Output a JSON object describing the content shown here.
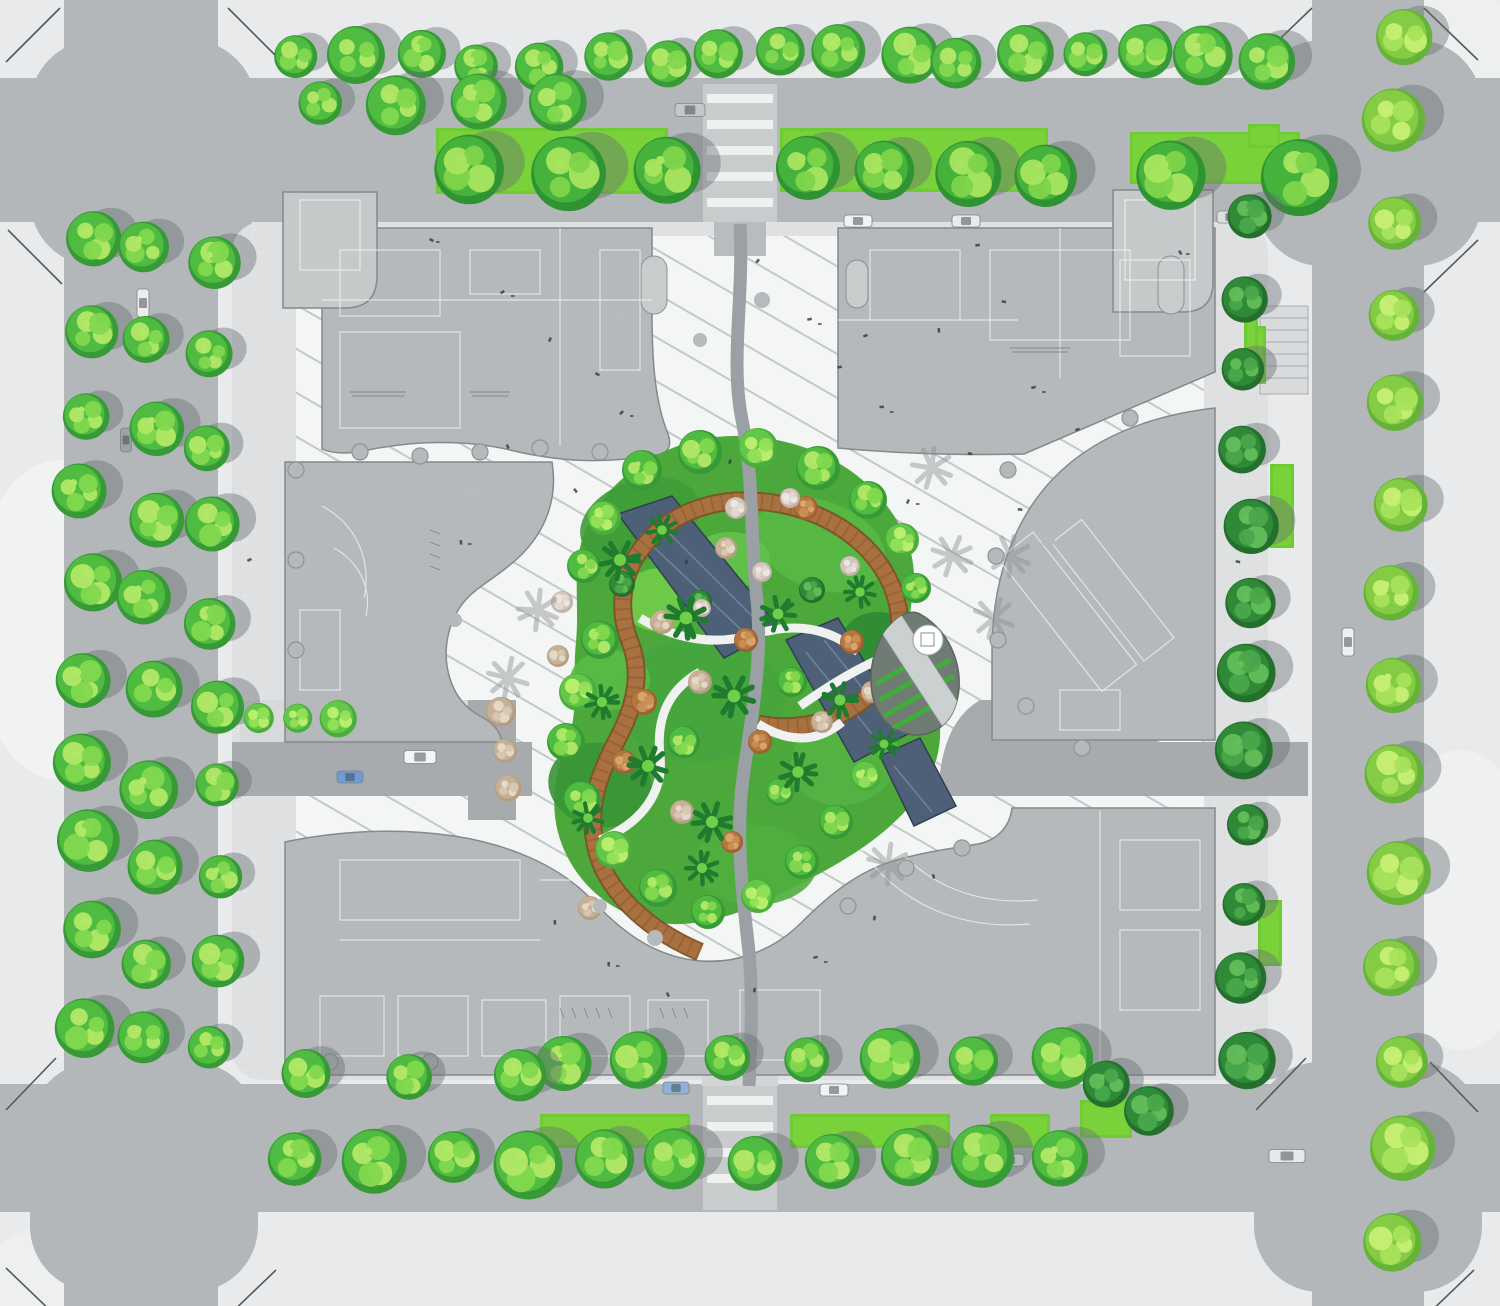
{
  "meta": {
    "type": "architectural-landscape-site-plan",
    "visible_text": "none",
    "features": [
      "street-intersections",
      "perimeter-tree-rows",
      "four-building-roofs",
      "striped-pinwheel-plaza",
      "central-garden",
      "reflecting-pools",
      "timber-ribbon-walk",
      "pavilion-teardrop",
      "grass-medians",
      "cars",
      "pedestrians"
    ]
  },
  "palette": {
    "background": "#e9eaeb",
    "road": "#b4b7b9",
    "road_dark": "#a7abad",
    "sidewalk": "#dfe1e2",
    "paver_line": "#c9cbcc",
    "plaza": "#f4f5f5",
    "stripe": "#c5c8c9",
    "building": "#b5b9bb",
    "building_stroke": "#85898b",
    "building_line": "#f2f4f4",
    "sub_building": "#c6c9ca",
    "water": "#4d6077",
    "water_edge": "#2f3f50",
    "water_streak": "#7e90a4",
    "ribbon": "#a9713f",
    "ribbon_dark": "#7e5227",
    "grass": "#6fcb33",
    "grass_light": "#8fdf4a",
    "pavilion": "#6f7b73",
    "pavilion_stripe": "#3fae3b",
    "shadow": "#666e73",
    "speck": "#3a3f42",
    "planter_dot": "#b6babc",
    "tree_types": {
      "g": {
        "base": "#379a36",
        "mid": "#4fbb41",
        "light": "#82d84e",
        "lime": "#b2e866"
      },
      "big": {
        "base": "#2f9233",
        "mid": "#45b23c",
        "light": "#7fd44a",
        "lime": "#a8e55e"
      },
      "lg": {
        "base": "#4aad3c",
        "mid": "#63c74a",
        "light": "#95e057",
        "lime": "#bdf06e"
      },
      "dg": {
        "base": "#256f2d",
        "mid": "#2f8a38",
        "light": "#4aa84b",
        "lime": "#63bd58"
      },
      "lime": {
        "base": "#66b33a",
        "mid": "#85cc45",
        "light": "#a8e35b",
        "lime": "#c6ef74"
      },
      "tan": {
        "base": "#b49e83",
        "mid": "#c6b096",
        "light": "#d8c8b2",
        "lime": "#e6dac8"
      },
      "rust": {
        "base": "#a05f32",
        "mid": "#b5763f",
        "light": "#c98f55",
        "lime": "#d9a86d"
      },
      "pale": {
        "base": "#c0b2a8",
        "mid": "#d3c6bd",
        "light": "#e4dad2",
        "lime": "#efe8e2"
      },
      "palm": {
        "base": "#1f7c2e",
        "mid": "#2f9338",
        "light": "#6fcf49",
        "lime": "#9ade5f"
      }
    }
  },
  "scene": {
    "tree_rows": [
      {
        "x1": 302,
        "y1": 60,
        "x2": 1262,
        "y2": 58,
        "n": 17,
        "r": 26,
        "j": 16,
        "t": "g",
        "s": 1
      },
      {
        "x1": 320,
        "y1": 108,
        "x2": 560,
        "y2": 104,
        "n": 4,
        "r": 26,
        "j": 10,
        "t": "g",
        "s": 1
      },
      {
        "x1": 466,
        "y1": 170,
        "x2": 664,
        "y2": 172,
        "n": 3,
        "r": 37,
        "j": 8,
        "t": "big",
        "s": 1
      },
      {
        "x1": 806,
        "y1": 170,
        "x2": 1044,
        "y2": 172,
        "n": 4,
        "r": 36,
        "j": 8,
        "t": "big",
        "s": 1
      },
      {
        "x1": 1168,
        "y1": 176,
        "x2": 1298,
        "y2": 178,
        "n": 2,
        "r": 34,
        "j": 6,
        "t": "big",
        "s": 1
      },
      {
        "x1": 88,
        "y1": 238,
        "x2": 88,
        "y2": 1020,
        "n": 10,
        "r": 27,
        "j": 18,
        "t": "g",
        "s": 1
      },
      {
        "x1": 152,
        "y1": 256,
        "x2": 152,
        "y2": 1044,
        "n": 10,
        "r": 28,
        "j": 18,
        "t": "g",
        "s": 1
      },
      {
        "x1": 214,
        "y1": 268,
        "x2": 214,
        "y2": 1052,
        "n": 10,
        "r": 26,
        "j": 16,
        "t": "g",
        "s": 1
      },
      {
        "x1": 1246,
        "y1": 218,
        "x2": 1246,
        "y2": 1058,
        "n": 12,
        "r": 25,
        "j": 12,
        "t": "dg",
        "s": 1
      },
      {
        "x1": 1398,
        "y1": 34,
        "x2": 1398,
        "y2": 1244,
        "n": 14,
        "r": 29,
        "j": 14,
        "t": "lime",
        "s": 1
      },
      {
        "x1": 560,
        "y1": 1062,
        "x2": 1058,
        "y2": 1060,
        "n": 7,
        "r": 27,
        "j": 10,
        "t": "g",
        "s": 1
      },
      {
        "x1": 302,
        "y1": 1072,
        "x2": 516,
        "y2": 1072,
        "n": 3,
        "r": 26,
        "j": 10,
        "t": "g",
        "s": 1
      },
      {
        "x1": 296,
        "y1": 1162,
        "x2": 1062,
        "y2": 1162,
        "n": 11,
        "r": 30,
        "j": 12,
        "t": "g",
        "s": 1
      },
      {
        "x1": 258,
        "y1": 718,
        "x2": 338,
        "y2": 718,
        "n": 3,
        "r": 16,
        "j": 4,
        "t": "lg",
        "s": 0
      },
      {
        "x1": 500,
        "y1": 712,
        "x2": 510,
        "y2": 786,
        "n": 3,
        "r": 14,
        "j": 6,
        "t": "tan",
        "s": 0
      },
      {
        "x1": 1108,
        "y1": 1086,
        "x2": 1150,
        "y2": 1112,
        "n": 2,
        "r": 24,
        "j": 6,
        "t": "dg",
        "s": 1
      }
    ],
    "garden_trees": [
      [
        642,
        470,
        20,
        "g"
      ],
      [
        700,
        452,
        22,
        "g"
      ],
      [
        758,
        448,
        20,
        "lg"
      ],
      [
        818,
        468,
        22,
        "g"
      ],
      [
        868,
        500,
        19,
        "g"
      ],
      [
        902,
        540,
        17,
        "lg"
      ],
      [
        916,
        588,
        15,
        "g"
      ],
      [
        604,
        518,
        17,
        "lg"
      ],
      [
        584,
        566,
        17,
        "g"
      ],
      [
        600,
        640,
        19,
        "g"
      ],
      [
        578,
        692,
        19,
        "lg"
      ],
      [
        566,
        742,
        19,
        "g"
      ],
      [
        582,
        800,
        19,
        "g"
      ],
      [
        614,
        850,
        19,
        "lg"
      ],
      [
        658,
        888,
        19,
        "g"
      ],
      [
        708,
        912,
        17,
        "g"
      ],
      [
        758,
        896,
        17,
        "lg"
      ],
      [
        802,
        862,
        17,
        "g"
      ],
      [
        836,
        822,
        17,
        "g"
      ],
      [
        866,
        776,
        15,
        "lg"
      ],
      [
        896,
        640,
        13,
        "g"
      ],
      [
        792,
        682,
        15,
        "g"
      ],
      [
        780,
        792,
        14,
        "g"
      ],
      [
        684,
        742,
        16,
        "g"
      ],
      [
        622,
        584,
        13,
        "dg"
      ],
      [
        700,
        602,
        12,
        "dg"
      ],
      [
        812,
        590,
        13,
        "dg"
      ],
      [
        644,
        702,
        13,
        "rust"
      ],
      [
        760,
        742,
        12,
        "rust"
      ],
      [
        746,
        640,
        12,
        "rust"
      ],
      [
        852,
        642,
        12,
        "rust"
      ],
      [
        624,
        762,
        12,
        "rust"
      ],
      [
        732,
        842,
        11,
        "rust"
      ],
      [
        806,
        508,
        12,
        "rust"
      ],
      [
        700,
        682,
        12,
        "tan"
      ],
      [
        822,
        722,
        11,
        "tan"
      ],
      [
        662,
        622,
        12,
        "tan"
      ],
      [
        872,
        692,
        11,
        "tan"
      ],
      [
        682,
        812,
        12,
        "tan"
      ],
      [
        558,
        656,
        11,
        "tan"
      ],
      [
        590,
        908,
        12,
        "tan"
      ],
      [
        726,
        548,
        11,
        "tan"
      ],
      [
        736,
        508,
        11,
        "pale"
      ],
      [
        790,
        498,
        10,
        "pale"
      ],
      [
        762,
        572,
        10,
        "pale"
      ],
      [
        562,
        602,
        11,
        "pale"
      ],
      [
        702,
        608,
        9,
        "pale"
      ],
      [
        850,
        566,
        10,
        "pale"
      ],
      [
        620,
        560,
        19,
        "palm"
      ],
      [
        686,
        618,
        20,
        "palm"
      ],
      [
        734,
        696,
        20,
        "palm"
      ],
      [
        648,
        766,
        19,
        "palm"
      ],
      [
        712,
        822,
        19,
        "palm"
      ],
      [
        798,
        772,
        18,
        "palm"
      ],
      [
        840,
        700,
        17,
        "palm"
      ],
      [
        778,
        614,
        17,
        "palm"
      ],
      [
        860,
        592,
        15,
        "palm"
      ],
      [
        602,
        702,
        16,
        "palm"
      ],
      [
        588,
        818,
        15,
        "palm"
      ],
      [
        702,
        868,
        16,
        "palm"
      ],
      [
        662,
        530,
        15,
        "palm"
      ],
      [
        884,
        744,
        14,
        "palm"
      ]
    ],
    "palm_shadows": [
      [
        952,
        556
      ],
      [
        994,
        618
      ],
      [
        932,
        468
      ],
      [
        888,
        864
      ],
      [
        538,
        610
      ],
      [
        508,
        678
      ],
      [
        1010,
        556
      ]
    ],
    "pools": [
      {
        "pts": "618,514 672,496 780,628 724,658",
        "streaks": [
          [
            640,
            534,
            752,
            640
          ],
          [
            660,
            524,
            766,
            630
          ]
        ]
      },
      {
        "pts": "786,640 838,618 908,734 854,762",
        "streaks": [
          [
            806,
            652,
            880,
            744
          ],
          [
            824,
            640,
            896,
            730
          ]
        ]
      },
      {
        "pts": "880,756 920,738 956,806 914,826",
        "streaks": [
          [
            894,
            766,
            932,
            812
          ]
        ]
      }
    ],
    "grass": [
      [
        436,
        128,
        232,
        66
      ],
      [
        780,
        128,
        268,
        64
      ],
      [
        1130,
        132,
        170,
        52
      ],
      [
        540,
        1114,
        150,
        34
      ],
      [
        790,
        1114,
        160,
        34
      ],
      [
        990,
        1114,
        60,
        34
      ],
      [
        1246,
        326,
        20,
        58
      ],
      [
        1270,
        464,
        24,
        84
      ],
      [
        1258,
        900,
        24,
        66
      ],
      [
        1248,
        124,
        32,
        24
      ],
      [
        1080,
        1100,
        52,
        38
      ],
      [
        1244,
        316,
        14,
        66
      ]
    ],
    "cars": [
      [
        690,
        110,
        30,
        13,
        0,
        "#c4c8ca"
      ],
      [
        858,
        221,
        28,
        12,
        0,
        "#f1f2f2"
      ],
      [
        966,
        221,
        28,
        12,
        0,
        "#e9ebec"
      ],
      [
        1230,
        217,
        26,
        12,
        0,
        "#dde0e1"
      ],
      [
        420,
        757,
        32,
        13,
        0,
        "#f4f5f5"
      ],
      [
        350,
        777,
        26,
        12,
        0,
        "#6f9bd2"
      ],
      [
        676,
        1088,
        26,
        12,
        0,
        "#8fb1d8"
      ],
      [
        834,
        1090,
        28,
        12,
        0,
        "#f1f2f2"
      ],
      [
        1010,
        1160,
        28,
        12,
        0,
        "#eceeee"
      ],
      [
        1287,
        1156,
        36,
        13,
        0,
        "#e6e8e9"
      ],
      [
        1348,
        642,
        28,
        12,
        90,
        "#eff0f1"
      ],
      [
        143,
        303,
        28,
        12,
        90,
        "#eceeee"
      ],
      [
        126,
        440,
        24,
        11,
        90,
        "#9aa2a8"
      ]
    ],
    "planter_dots": [
      [
        617,
        318,
        9
      ],
      [
        530,
        400,
        8
      ],
      [
        472,
        492,
        9
      ],
      [
        928,
        306,
        8
      ],
      [
        986,
        360,
        9
      ],
      [
        655,
        938,
        8
      ],
      [
        600,
        906,
        7
      ],
      [
        862,
        944,
        8
      ],
      [
        700,
        340,
        7
      ],
      [
        762,
        300,
        8
      ],
      [
        1048,
        540,
        7
      ],
      [
        455,
        620,
        7
      ]
    ],
    "specks": [
      [
        505,
        292
      ],
      [
        552,
        338
      ],
      [
        596,
        372
      ],
      [
        624,
        412
      ],
      [
        508,
        444
      ],
      [
        575,
        488
      ],
      [
        462,
        540
      ],
      [
        940,
        328
      ],
      [
        1002,
        300
      ],
      [
        1036,
        388
      ],
      [
        968,
        452
      ],
      [
        1018,
        508
      ],
      [
        884,
        408
      ],
      [
        842,
        368
      ],
      [
        556,
        920
      ],
      [
        610,
        962
      ],
      [
        668,
        992
      ],
      [
        756,
        988
      ],
      [
        818,
        958
      ],
      [
        876,
        916
      ],
      [
        934,
        874
      ],
      [
        812,
        320
      ],
      [
        868,
        336
      ],
      [
        1080,
        430
      ],
      [
        910,
        500
      ],
      [
        252,
        560
      ],
      [
        1236,
        560
      ],
      [
        1236,
        760
      ],
      [
        640,
        1072
      ],
      [
        900,
        1068
      ],
      [
        430,
        238
      ],
      [
        760,
        260
      ],
      [
        980,
        246
      ],
      [
        1180,
        250
      ],
      [
        688,
        560
      ],
      [
        732,
        460
      ]
    ],
    "columns": [
      [
        360,
        452
      ],
      [
        420,
        456
      ],
      [
        480,
        452
      ],
      [
        540,
        448
      ],
      [
        600,
        452
      ],
      [
        1008,
        470
      ],
      [
        996,
        556
      ],
      [
        998,
        640
      ],
      [
        1026,
        706
      ],
      [
        1082,
        748
      ],
      [
        848,
        906
      ],
      [
        906,
        868
      ],
      [
        962,
        848
      ],
      [
        330,
        1062
      ],
      [
        430,
        1062
      ],
      [
        530,
        1062
      ],
      [
        630,
        1062
      ],
      [
        730,
        1062
      ],
      [
        296,
        470
      ],
      [
        296,
        560
      ],
      [
        296,
        650
      ],
      [
        1130,
        418
      ]
    ]
  }
}
